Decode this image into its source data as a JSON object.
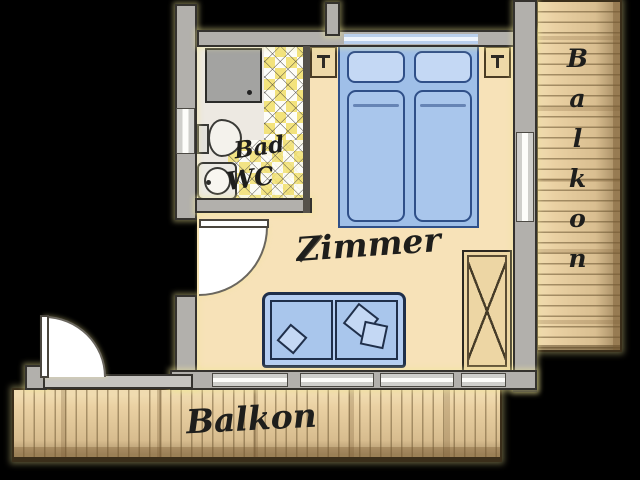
{
  "plan": {
    "title": "Apartment floor plan",
    "bathroom": {
      "label_bad": "Bad",
      "label_wc": "WC"
    },
    "bedroom": {
      "label": "Zimmer"
    },
    "balcony_south": {
      "label": "Balkon"
    },
    "balcony_east": {
      "label": "Balkon"
    }
  },
  "colors": {
    "background": "#000000",
    "wall_fill": "#b2b0ac",
    "wall_outline": "#34322e",
    "floor": "#f7e2b8",
    "bathroom_floor": "#ede9e2",
    "wood": "#ead1a3",
    "tile_accent": "#f3e37c",
    "furniture_blue": "#a9c6ec",
    "furniture_blue_outline": "#2f4f88",
    "cabinet_tan": "#edd6a4",
    "label_text": "#1e1e1c"
  }
}
